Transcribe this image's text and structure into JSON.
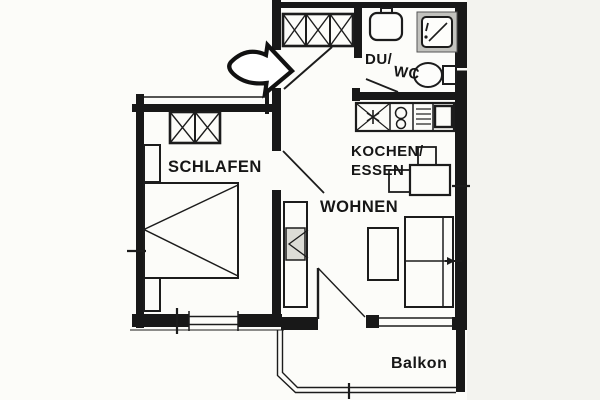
{
  "rooms": {
    "bedroom": {
      "label": "SCHLAFEN"
    },
    "living": {
      "label": "WOHNEN"
    },
    "kitchen_dining": {
      "line1": "KOCHEN/",
      "line2": "ESSEN"
    },
    "shower_wc": {
      "line1": "DU/",
      "line2": "WC"
    },
    "balcony": {
      "label": "Balkon"
    }
  },
  "colors": {
    "background": "#fcfcf9",
    "outside_shade": "#f3f3ef",
    "wall": "#181818",
    "line": "#1c1c1c",
    "shower_frame": "#c2c2be",
    "media_box": "#dcdcd6"
  },
  "icons": {
    "entrance_arrow": "curved-block-arrow-right",
    "wardrobe": "crossed-box-grid",
    "bed": "rectangle-with-zigzag",
    "kitchen_sink": "crossed-box-with-star",
    "stove": "two-burner-circles",
    "dishwasher": "striped-box",
    "fridge": "bold-square",
    "washbasin": "rounded-basin-with-tap",
    "shower": "gray-framed-square-with-drain",
    "toilet": "bowl-with-cistern"
  }
}
